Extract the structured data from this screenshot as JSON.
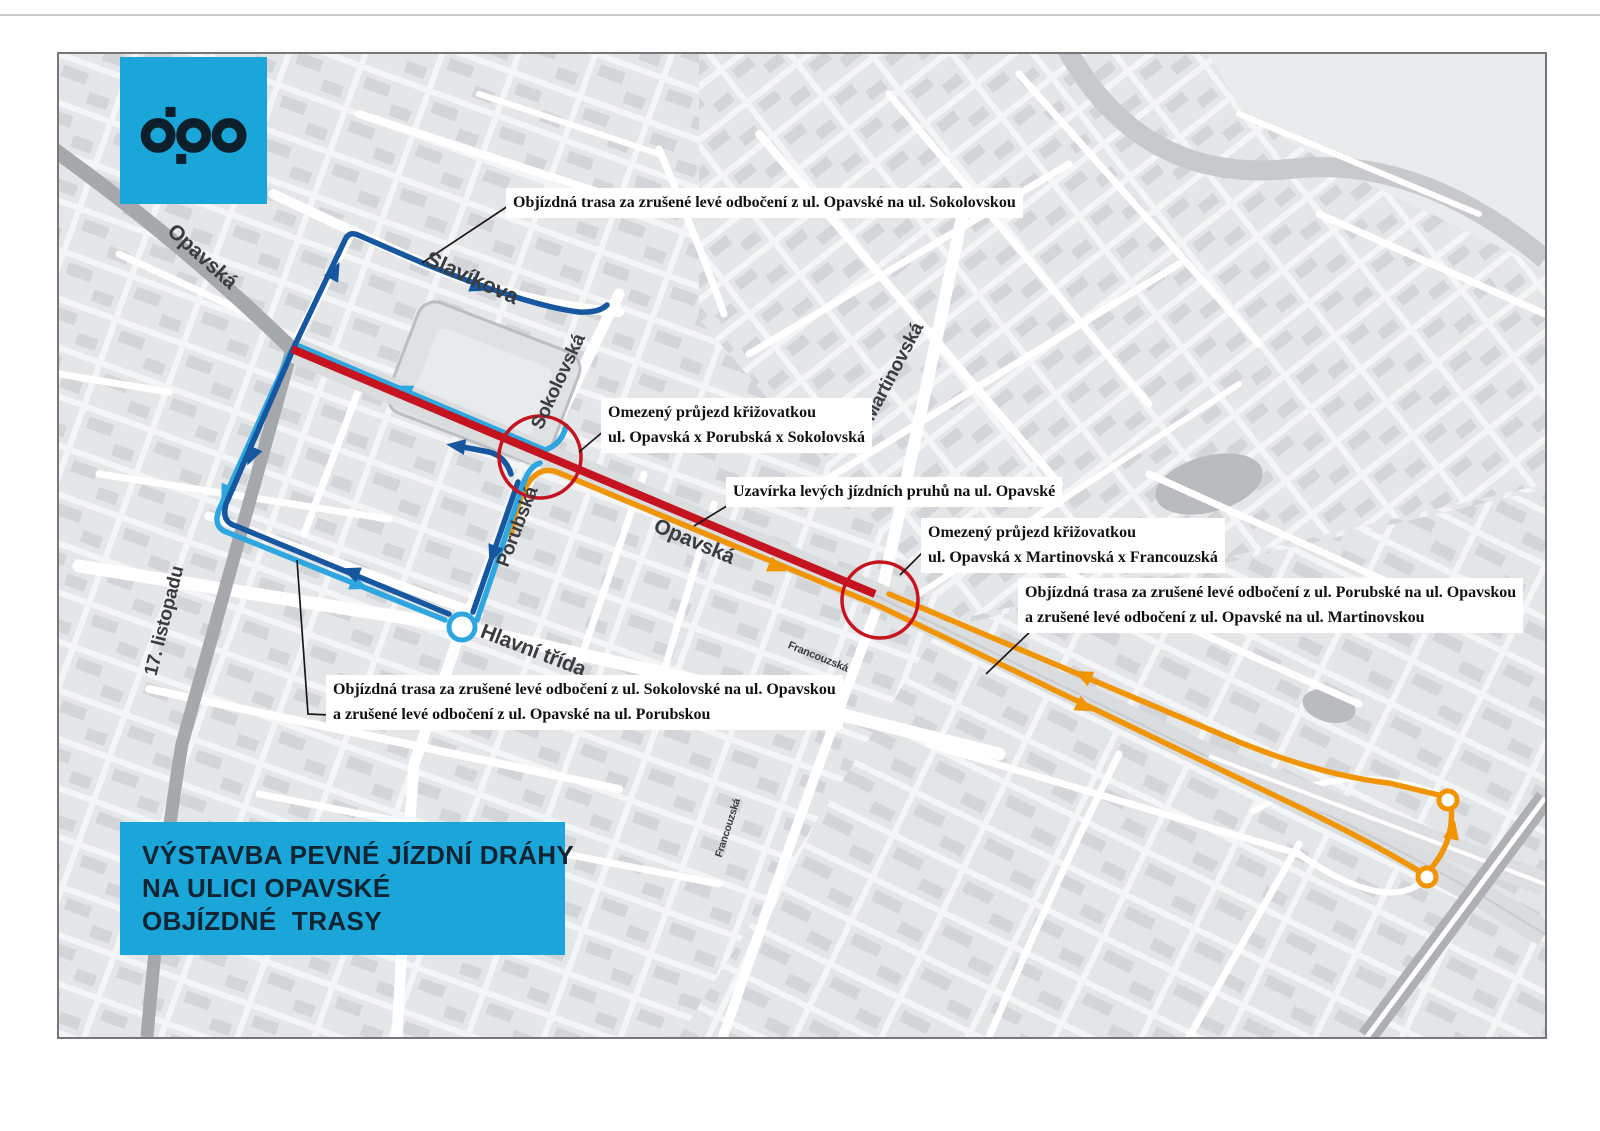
{
  "logo": {
    "text": "dpo"
  },
  "title_box": {
    "lines": [
      "VÝSTAVBA PEVNÉ JÍZDNÍ DRÁHY",
      "NA ULICI OPAVSKÉ",
      "OBJÍZDNÉ  TRASY"
    ]
  },
  "annotations": [
    {
      "lines": [
        "Objízdná trasa za zrušené levé odbočení z ul. Opavské na ul. Sokolovskou"
      ]
    },
    {
      "lines": [
        "Omezený průjezd křižovatkou",
        "ul. Opavská x Porubská x Sokolovská"
      ]
    },
    {
      "lines": [
        "Uzavírka levých jízdních pruhů na ul. Opavské"
      ]
    },
    {
      "lines": [
        "Omezený průjezd křižovatkou",
        "ul. Opavská x Martinovská x Francouzská"
      ]
    },
    {
      "lines": [
        "Objízdná trasa za zrušené levé odbočení z ul. Porubské na ul. Opavskou",
        "a zrušené levé odbočení z ul. Opavské na ul. Martinovskou"
      ]
    },
    {
      "lines": [
        "Objízdná trasa za zrušené levé odbočení z ul. Sokolovské na ul. Opavskou",
        "a zrušené levé odbočení z ul. Opavské na ul. Porubskou"
      ]
    }
  ],
  "streets": [
    {
      "name": "Opavská"
    },
    {
      "name": "Slavíkova"
    },
    {
      "name": "Sokolovská"
    },
    {
      "name": "Porubská"
    },
    {
      "name": "Opavská"
    },
    {
      "name": "Martinovská"
    },
    {
      "name": "Hlavní třída"
    },
    {
      "name": "17. listopadu"
    },
    {
      "name": "Francouzská"
    },
    {
      "name": "Francouzská"
    }
  ],
  "routes": [
    {
      "id": "closure",
      "color": "#c51320",
      "style": "solid-thick"
    },
    {
      "id": "detour-dark-blue",
      "color": "#1657a0"
    },
    {
      "id": "detour-light-blue",
      "color": "#2ea7e0"
    },
    {
      "id": "detour-orange",
      "color": "#f09400"
    }
  ],
  "colors": {
    "accent": "#1aa6d8",
    "logo_ink": "#0e1f2c",
    "title_ink": "#102433",
    "route_red": "#c51320",
    "route_dark_blue": "#1657a0",
    "route_light_blue": "#2ea7e0",
    "route_orange": "#f09400",
    "label_ink": "#3a3c3f"
  }
}
